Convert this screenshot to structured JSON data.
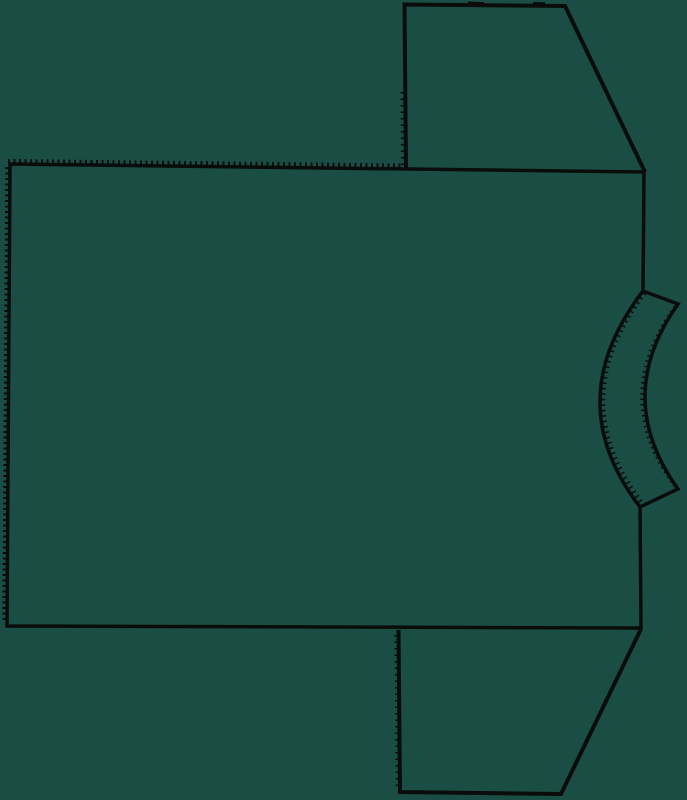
{
  "canvas": {
    "width": 687,
    "height": 800,
    "background_color": "#1a4e45",
    "line_color": "#0a0c0b"
  },
  "pieces": {
    "body_panel": {
      "outline": "M643,291 L644,172 L10,164 L7,626 L641,628 L640,508",
      "serration_top": "M8,161 L406,165.5",
      "serration_left": "M7.3,167 L4.3,623"
    },
    "sleeve_top": {
      "outline": "M406,168 L404.5,4.5 L565,6 L645,172",
      "serration_left": "M402.5,92 L403,166",
      "notch_a": "M468,2.6 L484,3.2",
      "notch_b": "M533,3 L545,3.5"
    },
    "sleeve_bottom": {
      "outline": "M398.5,630 L400,792 L561,794 L641,629",
      "serration_left": "M396.3,635 L397.8,789"
    },
    "neckband": {
      "outline": "M643,291 L678,304 Q612,397 678,489 L640,507 Q558.5,401 643,291 Z",
      "rough_outer": "M644.5,293 Q563,401 642,503",
      "rough_inner": "M675.5,307 Q609.5,397.5 675.5,486"
    }
  }
}
